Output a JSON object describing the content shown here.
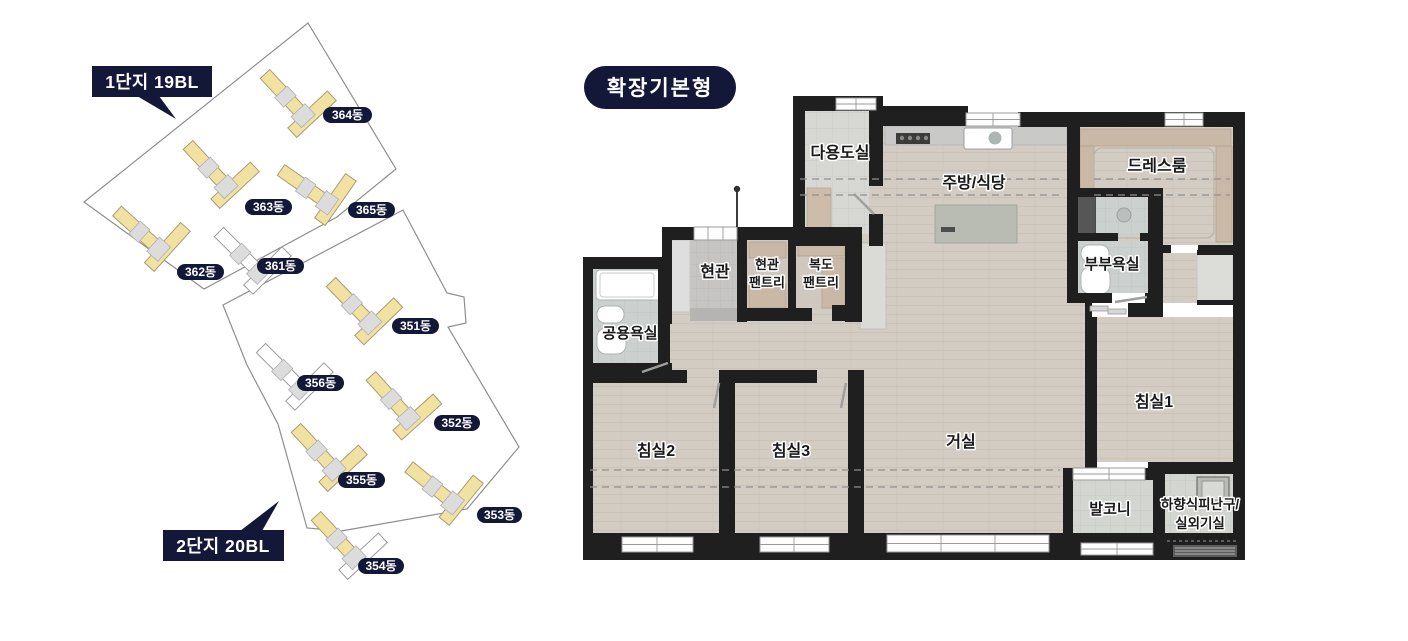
{
  "site": {
    "complex1": "1단지 19BL",
    "complex2": "2단지 20BL",
    "buildings": [
      {
        "label": "364동"
      },
      {
        "label": "363동"
      },
      {
        "label": "365동"
      },
      {
        "label": "362동"
      },
      {
        "label": "361동"
      },
      {
        "label": "351동"
      },
      {
        "label": "356동"
      },
      {
        "label": "352동"
      },
      {
        "label": "355동"
      },
      {
        "label": "353동"
      },
      {
        "label": "354동"
      }
    ]
  },
  "plan": {
    "badge": "확장기본형",
    "rooms": {
      "utility": "다용도실",
      "kitchen": "주방/식당",
      "dressroom": "드레스룸",
      "entrance": "현관",
      "entrance_pantry_1": "현관",
      "entrance_pantry_2": "팬트리",
      "corridor_pantry_1": "복도",
      "corridor_pantry_2": "팬트리",
      "master_bath": "부부욕실",
      "common_bath": "공용욕실",
      "bedroom2": "침실2",
      "bedroom3": "침실3",
      "living": "거실",
      "bedroom1": "침실1",
      "balcony": "발코니",
      "escape_1": "하향식피난구/",
      "escape_2": "실외기실"
    }
  },
  "colors": {
    "accent_navy": "#141838",
    "building_yellow": "#f2e2a2",
    "wall_black": "#1f1f1f",
    "wood_floor": "#d2ccc3"
  }
}
